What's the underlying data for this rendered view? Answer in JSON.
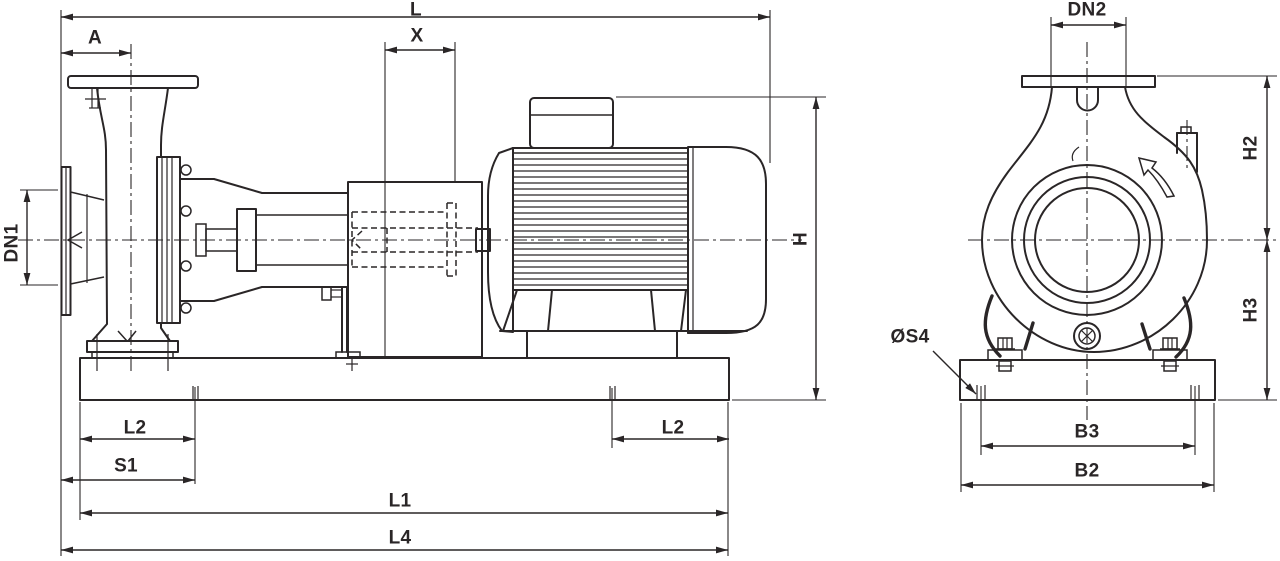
{
  "drawing_title": "End-suction pump with motor — dimensional drawing (side view and end view)",
  "colors": {
    "background": "#ffffff",
    "line": "#2a2627"
  },
  "views": [
    {
      "id": "side-view",
      "dimension_labels": [
        "L",
        "A",
        "X",
        "DN1",
        "H",
        "L2",
        "S1",
        "L1",
        "L4",
        "L2"
      ]
    },
    {
      "id": "end-view",
      "dimension_labels": [
        "DN2",
        "H2",
        "H3",
        "ØS4",
        "B3",
        "B2"
      ]
    }
  ],
  "labels": {
    "L": "L",
    "A": "A",
    "X": "X",
    "DN1": "DN1",
    "H": "H",
    "L2_left": "L2",
    "S1": "S1",
    "L1": "L1",
    "L4": "L4",
    "L2_right": "L2",
    "DN2": "DN2",
    "H2": "H2",
    "H3": "H3",
    "S4": "ØS4",
    "B3": "B3",
    "B2": "B2"
  }
}
